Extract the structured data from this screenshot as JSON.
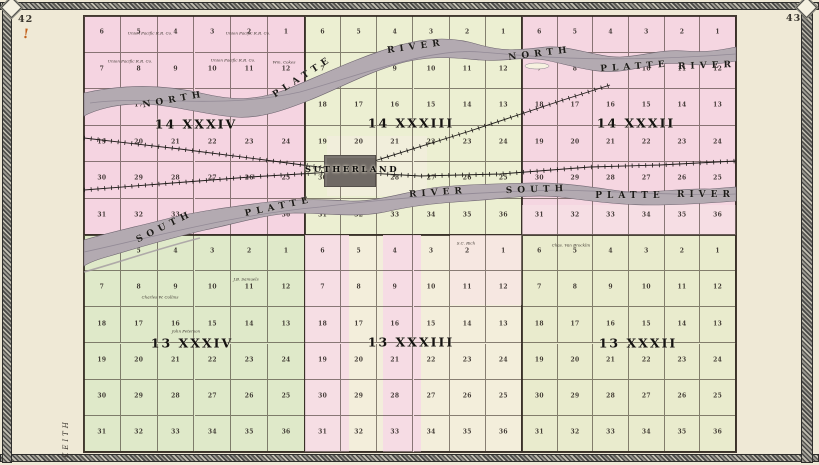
{
  "page": {
    "left_number": "42",
    "right_number": "43",
    "adjacent_county_label": "KEITH",
    "stray_mark": "!"
  },
  "colors": {
    "paper": "#f6f1e0",
    "page_bg": "#efe9d6",
    "river_fill": "#b3aab1",
    "river_streak": "#8b8290",
    "rail": "#1f1c1a",
    "town_fill": "#6f6964"
  },
  "map": {
    "frame": {
      "x": 84,
      "y": 16,
      "w": 652,
      "h": 436
    },
    "section_grid": [
      [
        6,
        5,
        4,
        3,
        2,
        1
      ],
      [
        7,
        8,
        9,
        10,
        11,
        12
      ],
      [
        18,
        17,
        16,
        15,
        14,
        13
      ],
      [
        19,
        20,
        21,
        22,
        23,
        24
      ],
      [
        30,
        29,
        28,
        27,
        26,
        25
      ],
      [
        31,
        32,
        33,
        34,
        35,
        36
      ]
    ],
    "townships": [
      {
        "label": "14 XXXIV",
        "x": 84,
        "y": 16,
        "w": 221,
        "h": 219,
        "color": "#f5d4e1",
        "lx": 196,
        "ly": 124
      },
      {
        "label": "14 XXXIII",
        "x": 305,
        "y": 16,
        "w": 217,
        "h": 219,
        "color": "#ecefd2",
        "lx": 411,
        "ly": 123
      },
      {
        "label": "14 XXXII",
        "x": 522,
        "y": 16,
        "w": 214,
        "h": 219,
        "color": "#f5d6e1",
        "lx": 636,
        "ly": 123
      },
      {
        "label": "13 XXXIV",
        "x": 84,
        "y": 235,
        "w": 221,
        "h": 217,
        "color": "#dfe9c9",
        "lx": 192,
        "ly": 343
      },
      {
        "label": "13 XXXIII",
        "x": 305,
        "y": 235,
        "w": 217,
        "h": 217,
        "color": "#f3eedb",
        "lx": 411,
        "ly": 342
      },
      {
        "label": "13 XXXII",
        "x": 522,
        "y": 235,
        "w": 214,
        "h": 217,
        "color": "#e9ebcd",
        "lx": 638,
        "ly": 343
      }
    ],
    "patches": [
      {
        "x": 305,
        "y": 235,
        "w": 44,
        "h": 217,
        "color": "#f6dbe5",
        "opacity": 0.85
      },
      {
        "x": 383,
        "y": 235,
        "w": 38,
        "h": 217,
        "color": "#f6d9e4",
        "opacity": 0.9
      },
      {
        "x": 450,
        "y": 235,
        "w": 72,
        "h": 70,
        "color": "#f6e4e4",
        "opacity": 0.7
      },
      {
        "x": 327,
        "y": 136,
        "w": 100,
        "h": 60,
        "color": "#f2eedd",
        "opacity": 0.8
      },
      {
        "x": 522,
        "y": 205,
        "w": 214,
        "h": 30,
        "color": "#f7e2e6",
        "opacity": 0.6
      }
    ],
    "rivers": [
      {
        "name": "north-platte-river",
        "path": "M84,93 C120,85 160,83 205,94 C235,101 258,100 285,90 C320,76 355,58 400,45 C430,37 455,37 480,45 C505,52 520,50 545,47 C570,45 595,57 620,57 C645,56 660,49 685,51 C710,53 725,49 736,47 L736,61 C720,64 700,66 685,64 C660,61 645,68 620,71 C595,74 570,65 545,60 C520,56 505,62 480,60 C455,58 435,55 405,62 C370,71 340,88 310,100 C285,110 260,119 235,117 C205,115 170,104 140,104 C115,104 95,110 84,116 Z",
        "streak": "M90,103 C150,95 220,110 300,92 C370,72 430,48 480,52 C530,56 600,64 736,54"
      },
      {
        "name": "south-platte-river",
        "path": "M84,240 C110,232 140,226 170,218 C200,211 230,207 260,203 C290,199 320,199 350,201 C380,202 410,190 440,187 C470,184 500,184 530,183 C560,182 590,187 620,191 C650,194 680,188 710,189 L736,187 L736,201 C710,203 680,205 650,205 C620,205 590,201 560,197 C530,194 500,199 470,201 C440,203 415,205 385,212 C355,218 325,213 295,213 C265,214 235,224 205,230 C175,237 140,247 110,256 C95,260 87,264 84,266 Z",
        "streak": "M84,252 C150,238 230,215 320,207 C400,197 480,192 560,190 C630,192 690,196 736,194"
      }
    ],
    "side_channel": "M84,272 C120,262 160,248 200,238",
    "island": {
      "cx": 537,
      "cy": 66,
      "rx": 12,
      "ry": 3
    },
    "river_labels": [
      {
        "text": "NORTH",
        "x": 174,
        "y": 100,
        "rot": -10
      },
      {
        "text": "PLATTE",
        "x": 303,
        "y": 77,
        "rot": -33
      },
      {
        "text": "RIVER",
        "x": 416,
        "y": 47,
        "rot": -8
      },
      {
        "text": "NORTH",
        "x": 540,
        "y": 54,
        "rot": -7
      },
      {
        "text": "PLATTE",
        "x": 635,
        "y": 67,
        "rot": -4
      },
      {
        "text": "RIVER",
        "x": 707,
        "y": 66,
        "rot": -2
      },
      {
        "text": "SOUTH",
        "x": 165,
        "y": 227,
        "rot": -26
      },
      {
        "text": "PLATTE",
        "x": 279,
        "y": 207,
        "rot": -12
      },
      {
        "text": "RIVER",
        "x": 438,
        "y": 193,
        "rot": -4
      },
      {
        "text": "SOUTH",
        "x": 537,
        "y": 190,
        "rot": -2
      },
      {
        "text": "PLATTE",
        "x": 630,
        "y": 196,
        "rot": 0
      },
      {
        "text": "RIVER",
        "x": 706,
        "y": 195,
        "rot": 0
      }
    ],
    "railroads": [
      {
        "points": "84,138 180,149 265,160 333,169"
      },
      {
        "points": "84,190 160,184 250,177 333,172"
      },
      {
        "points": "333,171 420,176 500,174 590,167 660,165 736,161"
      },
      {
        "points": "355,167 470,131 560,101 610,85"
      }
    ],
    "town": {
      "name": "SUTHERLAND",
      "x": 324,
      "y": 155,
      "w": 52,
      "h": 32,
      "lx": 352,
      "ly": 170
    },
    "owners": [
      {
        "text": "Union Pacific R.R. Co.",
        "x": 150,
        "y": 33
      },
      {
        "text": "Union Pacific R.R. Co.",
        "x": 248,
        "y": 33
      },
      {
        "text": "Union Pacific R.R. Co.",
        "x": 130,
        "y": 61
      },
      {
        "text": "Union Pacific R.R. Co.",
        "x": 233,
        "y": 60
      },
      {
        "text": "Wm. Cokes",
        "x": 284,
        "y": 62
      },
      {
        "text": "J.B. Samuels",
        "x": 246,
        "y": 279
      },
      {
        "text": "Charles W. Collins",
        "x": 160,
        "y": 297
      },
      {
        "text": "John Peterson",
        "x": 186,
        "y": 331
      },
      {
        "text": "S.C. Rich",
        "x": 466,
        "y": 243
      },
      {
        "text": "Chas. Van Brocklin",
        "x": 571,
        "y": 245
      }
    ]
  }
}
